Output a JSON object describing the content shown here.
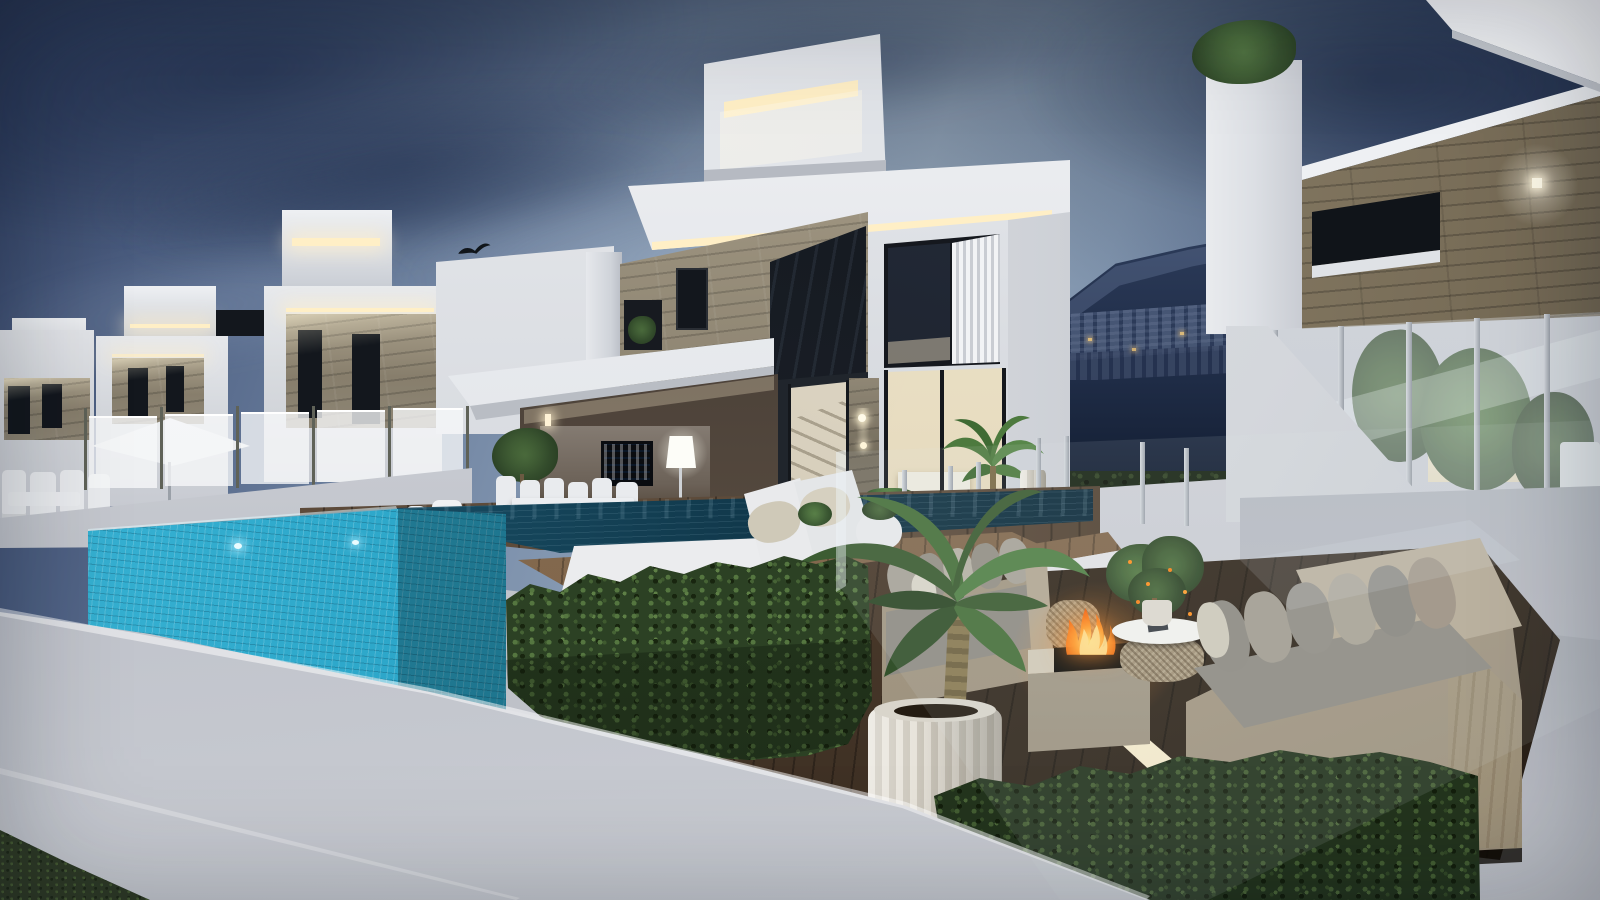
{
  "scene": {
    "type": "3d-architectural-render",
    "description": "Dusk exterior rendering of a development of modern cubic white villas with LED cove lighting, stone and wood accent facades, a glass-walled turquoise infinity pool, wooden deck terraces with white day beds, beige outdoor sofas, a burning fire pit, potted palms, trimmed hedges and a dark mountain with lit apartment buildings in the background",
    "time_of_day": "dusk",
    "objects": [
      {
        "label": "evening-sky-with-clouds"
      },
      {
        "label": "background-mountain-with-apartment-buildings"
      },
      {
        "label": "row-of-white-villas-left"
      },
      {
        "label": "central-villa-with-stone-facade-and-led-strips"
      },
      {
        "label": "rooftop-penthouse-box-with-cove-lighting"
      },
      {
        "label": "right-villa-with-wood-cladding-and-glass-balustrade"
      },
      {
        "label": "infinity-pool-with-turquoise-mosaic-glass-wall"
      },
      {
        "label": "underwater-pool-lights"
      },
      {
        "label": "wooden-pool-platform-with-white-day-beds"
      },
      {
        "label": "covered-terrace-with-tv-floor-lamp-and-dining-set"
      },
      {
        "label": "white-parasol"
      },
      {
        "label": "glass-pool-fence"
      },
      {
        "label": "outdoor-lounge-sofas-with-gray-cushions"
      },
      {
        "label": "square-stone-fire-pit-with-flames"
      },
      {
        "label": "rattan-coffee-table-with-citrus-tree"
      },
      {
        "label": "potted-palm-in-ribbed-white-pot"
      },
      {
        "label": "boxwood-hedges"
      },
      {
        "label": "white-perimeter-wall"
      },
      {
        "label": "grass-patch"
      },
      {
        "label": "flying-bird"
      }
    ]
  },
  "palette": {
    "sky_top_left": "#36466a",
    "sky_mid": "#7e92ad",
    "sky_light": "#99abbe",
    "sky_right": "#263450",
    "cloud_dark": "#22304f",
    "mountain_blue": "#1d2a44",
    "villa_white": "#e9ebee",
    "villa_shade": "#c9cdd4",
    "stone_tan": "#8d8574",
    "wood_clad": "#93876f",
    "led_warm": "#ffefc6",
    "window_dark": "#13171d",
    "interior_warm": "#efe7cf",
    "pool_turquoise": "#2aa4c7",
    "pool_deep": "#15749a",
    "water_dark": "#0e2f40",
    "deck_wood": "#5d4b3a",
    "platform_wood": "#7d6349",
    "deck_floor_dark": "#3a2e22",
    "hedge_green": "#2c4124",
    "hedge_light": "#557640",
    "grass_green": "#2f3b26",
    "wall_light": "#cdd0d7",
    "sofa_beige": "#b1a692",
    "cushion_gray": "#8f8c84",
    "daybed_white": "#ebecee",
    "fire_orange": "#ff7f1f",
    "fire_yellow": "#ffd23e",
    "pot_white": "#ddd9d0",
    "plant_green": "#3f6134",
    "tv_screen_blue": "#2b7ccc",
    "umbrella_white": "#e8eaed"
  }
}
